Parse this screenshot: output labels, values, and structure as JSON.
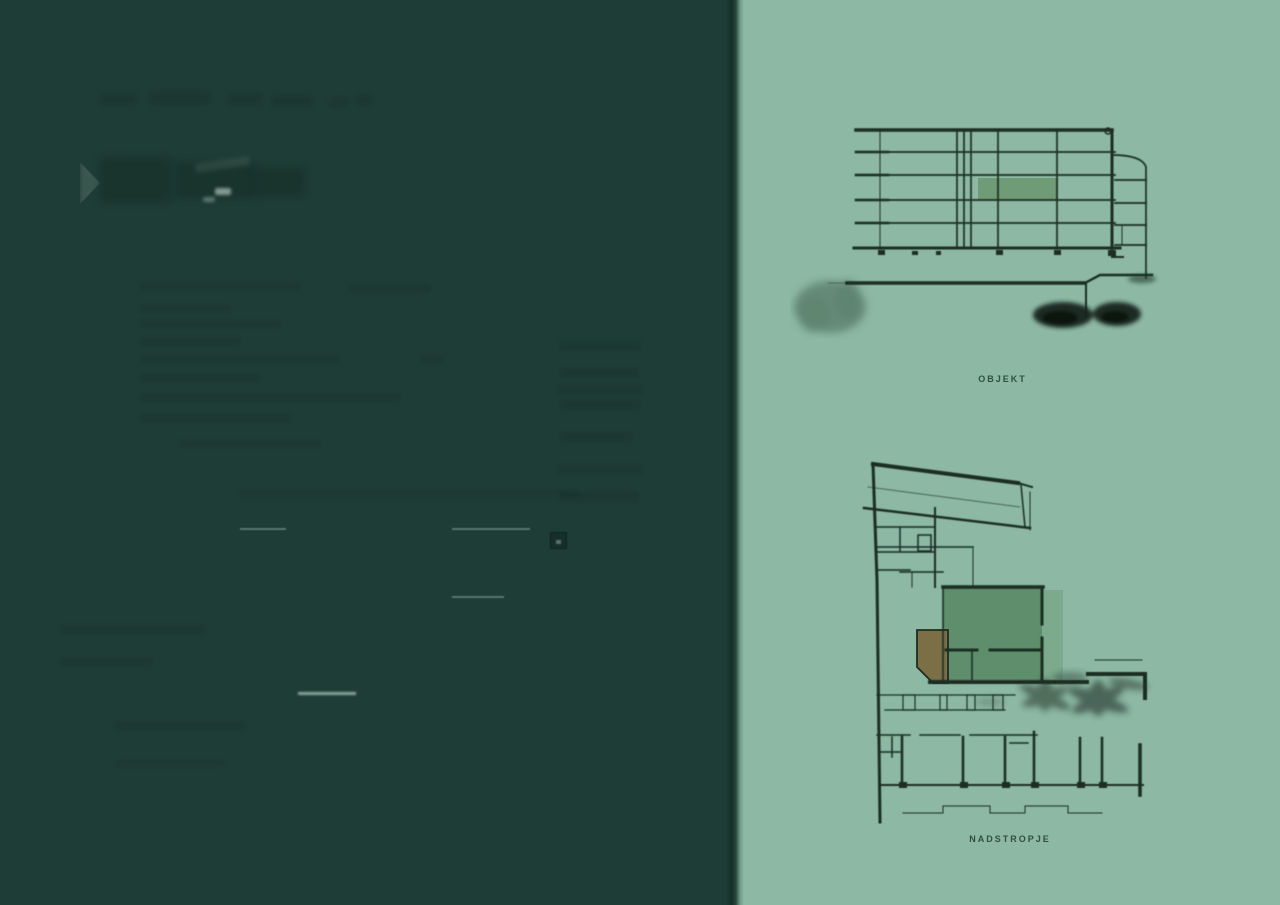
{
  "colors": {
    "left_panel_bg": "#1e3d36",
    "right_panel_bg": "#8cb8a4",
    "drawing_line": "#1c2d22",
    "elevation_highlight": "#6f9b77",
    "plan_highlight": "#5e8e6b",
    "plan_highlight_shadow": "#7aa88b",
    "plan_accent_brown": "#7c6e45",
    "label_text": "#2f4f43"
  },
  "figures": {
    "elevation": {
      "label": "OBJEKT"
    },
    "floor_plan": {
      "label": "NADSTROPJE"
    }
  }
}
